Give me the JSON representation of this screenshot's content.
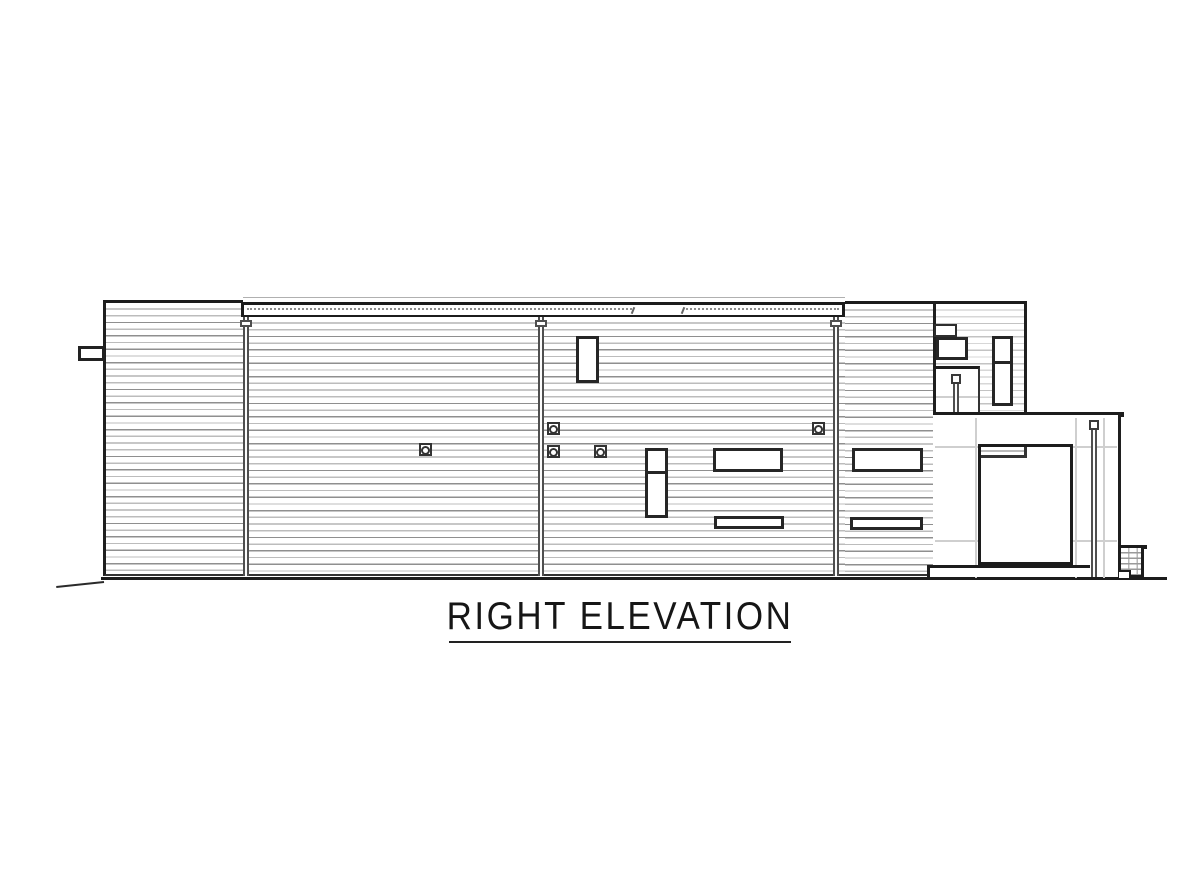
{
  "drawing": {
    "title": "RIGHT ELEVATION"
  },
  "colors": {
    "ink": "#1f1f1f",
    "siding_line": "#8f8f8f",
    "siding_line_light": "#c3c3c3",
    "panel_line": "#cfcfcf",
    "background": "#ffffff"
  }
}
